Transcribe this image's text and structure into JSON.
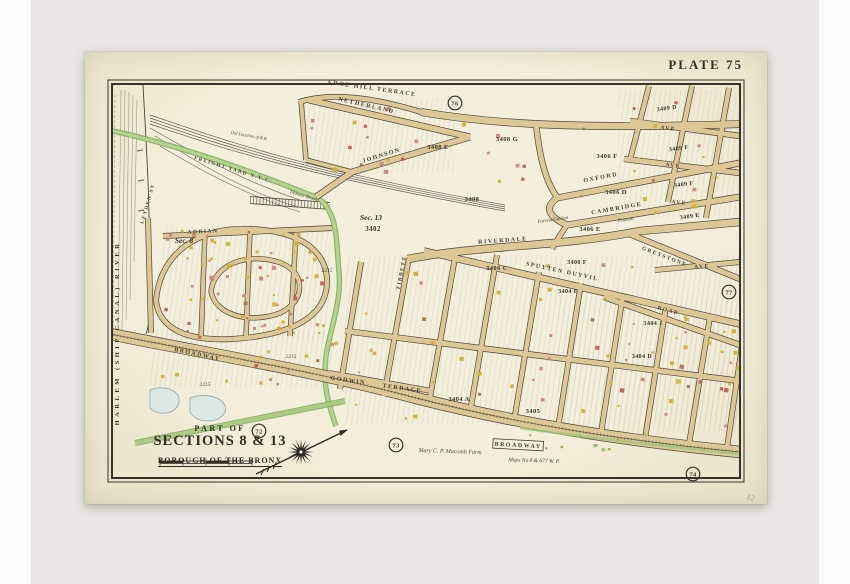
{
  "header": {
    "plate_label": "PLATE 75"
  },
  "title_block": {
    "part_of": "PART OF",
    "sections": "SECTIONS 8 & 13",
    "borough": "BOROUGH OF THE BRONX"
  },
  "map": {
    "colors": {
      "backdrop": "#e9e7e3",
      "paper": "#f2edd9",
      "road": "#dcc795",
      "ink": "#3f3b30",
      "brook": "#a6cb82",
      "building_yellow": "#d2b02c",
      "building_pink": "#cd8478",
      "building_red": "#bf5c4b",
      "building_brown": "#a8744d"
    },
    "labels": [
      {
        "t": "EDGE HILL TERRACE",
        "x": 372,
        "y": 90,
        "r": 8,
        "s": 6,
        "c": "st"
      },
      {
        "t": "NETHERLAND",
        "x": 366,
        "y": 107,
        "r": 13,
        "s": 6,
        "c": "st"
      },
      {
        "t": "JOHNSON",
        "x": 382,
        "y": 157,
        "r": -17,
        "s": 6,
        "c": "st"
      },
      {
        "t": "OXFORD",
        "x": 601,
        "y": 179,
        "r": -11,
        "s": 6,
        "c": "st"
      },
      {
        "t": "CAMBRIDGE",
        "x": 617,
        "y": 210,
        "r": -10,
        "s": 6,
        "c": "st"
      },
      {
        "t": "AVE",
        "x": 668,
        "y": 130,
        "r": 7,
        "s": 5.5,
        "c": "st"
      },
      {
        "t": "AVE",
        "x": 673,
        "y": 167,
        "r": 7,
        "s": 5.5,
        "c": "st"
      },
      {
        "t": "AVE",
        "x": 679,
        "y": 204,
        "r": 6,
        "s": 5.5,
        "c": "st"
      },
      {
        "t": "RIVERDALE",
        "x": 503,
        "y": 242,
        "r": -4,
        "s": 6,
        "c": "st"
      },
      {
        "t": "SPUYTEN DUYVIL",
        "x": 562,
        "y": 273,
        "r": 12,
        "s": 6,
        "c": "st"
      },
      {
        "t": "GREYSTONE",
        "x": 664,
        "y": 258,
        "r": 21,
        "s": 5.5,
        "c": "st"
      },
      {
        "t": "ROAD",
        "x": 668,
        "y": 312,
        "r": 15,
        "s": 5.5,
        "c": "st"
      },
      {
        "t": "AVE",
        "x": 702,
        "y": 268,
        "r": -3,
        "s": 5.5,
        "c": "st"
      },
      {
        "t": "TIBBETT",
        "x": 403,
        "y": 273,
        "r": -79,
        "s": 5.5,
        "c": "st"
      },
      {
        "t": "GODWIN",
        "x": 348,
        "y": 382,
        "r": 8,
        "s": 6,
        "c": "st"
      },
      {
        "t": "TERRACE",
        "x": 402,
        "y": 390,
        "r": 8,
        "s": 6,
        "c": "st"
      },
      {
        "t": "BROADWAY",
        "x": 197,
        "y": 356,
        "r": 12,
        "s": 6,
        "c": "st"
      },
      {
        "t": "ADRIAN",
        "x": 203,
        "y": 233,
        "r": -3,
        "s": 5.5,
        "c": "st"
      },
      {
        "t": "FREIGHT YARD N.Y.C.",
        "x": 233,
        "y": 171,
        "r": 17,
        "s": 5,
        "c": "st"
      },
      {
        "t": "LEYDEN ST",
        "x": 149,
        "y": 204,
        "r": -74,
        "s": 5,
        "c": "st"
      },
      {
        "t": "HARLEM (SHIP CANAL) RIVER",
        "x": 119,
        "y": 333,
        "r": -90,
        "s": 6.5,
        "c": "riv"
      },
      {
        "t": "BROADWAY",
        "x": 518,
        "y": 447,
        "r": 3,
        "s": 6,
        "c": "box"
      },
      {
        "t": "Sec. 8",
        "x": 184,
        "y": 243,
        "r": 0,
        "s": 7.5,
        "c": "sec"
      },
      {
        "t": "Sec. 13",
        "x": 371,
        "y": 220,
        "r": 0,
        "s": 7.5,
        "c": "sec"
      },
      {
        "t": "3402",
        "x": 373,
        "y": 231,
        "r": 0,
        "s": 7,
        "c": "num"
      },
      {
        "t": "3408 G",
        "x": 507,
        "y": 141,
        "r": 0,
        "s": 6.5,
        "c": "num"
      },
      {
        "t": "3408 E",
        "x": 438,
        "y": 149,
        "r": 0,
        "s": 6.5,
        "c": "num"
      },
      {
        "t": "3408",
        "x": 472,
        "y": 201,
        "r": 0,
        "s": 6.5,
        "c": "num"
      },
      {
        "t": "3409 D",
        "x": 667,
        "y": 110,
        "r": -8,
        "s": 6,
        "c": "num"
      },
      {
        "t": "3409 F",
        "x": 679,
        "y": 150,
        "r": -8,
        "s": 6,
        "c": "num"
      },
      {
        "t": "3409 F",
        "x": 684,
        "y": 186,
        "r": -8,
        "s": 6,
        "c": "num"
      },
      {
        "t": "3409 E",
        "x": 690,
        "y": 218,
        "r": -8,
        "s": 6,
        "c": "num"
      },
      {
        "t": "3406 F",
        "x": 607,
        "y": 158,
        "r": 0,
        "s": 6.5,
        "c": "num"
      },
      {
        "t": "3406 D",
        "x": 616,
        "y": 194,
        "r": 0,
        "s": 6.5,
        "c": "num"
      },
      {
        "t": "3406 E",
        "x": 590,
        "y": 231,
        "r": 0,
        "s": 6.5,
        "c": "num"
      },
      {
        "t": "3406 C",
        "x": 497,
        "y": 270,
        "r": 0,
        "s": 6.5,
        "c": "num"
      },
      {
        "t": "3400 F",
        "x": 577,
        "y": 264,
        "r": 0,
        "s": 6,
        "c": "num"
      },
      {
        "t": "3404 F",
        "x": 568,
        "y": 293,
        "r": 0,
        "s": 6,
        "c": "num"
      },
      {
        "t": "3404 J",
        "x": 653,
        "y": 325,
        "r": 0,
        "s": 6,
        "c": "num"
      },
      {
        "t": "3404 D",
        "x": 642,
        "y": 358,
        "r": 0,
        "s": 6,
        "c": "num"
      },
      {
        "t": "3404 A",
        "x": 459,
        "y": 401,
        "r": 0,
        "s": 6.5,
        "c": "num"
      },
      {
        "t": "3405",
        "x": 533,
        "y": 413,
        "r": 0,
        "s": 6.5,
        "c": "num"
      },
      {
        "t": "2215",
        "x": 327,
        "y": 272,
        "r": 0,
        "s": 5.5,
        "c": "it"
      },
      {
        "t": "2215",
        "x": 205,
        "y": 386,
        "r": 0,
        "s": 5.5,
        "c": "it"
      },
      {
        "t": "2215",
        "x": 291,
        "y": 358,
        "r": 0,
        "s": 5.5,
        "c": "it"
      },
      {
        "t": "Mary C. P. Macomb Farm",
        "x": 450,
        "y": 453,
        "r": 2,
        "s": 6,
        "c": "it"
      },
      {
        "t": "Maps No 8 & 677 W. P.",
        "x": 534,
        "y": 462,
        "r": 2,
        "s": 5.5,
        "c": "it"
      },
      {
        "t": "Forrest Garden",
        "x": 553,
        "y": 221,
        "r": -8,
        "s": 5,
        "c": "it"
      },
      {
        "t": "Putnam",
        "x": 626,
        "y": 221,
        "r": -8,
        "s": 5,
        "c": "it"
      },
      {
        "t": "Tibbetts Brook",
        "x": 303,
        "y": 197,
        "r": 17,
        "s": 5,
        "c": "it"
      },
      {
        "t": "Old Location of R.R.",
        "x": 249,
        "y": 137,
        "r": 10,
        "s": 4.5,
        "c": "it"
      },
      {
        "t": "12",
        "x": 750,
        "y": 500,
        "r": 14,
        "s": 8,
        "c": "pencil"
      }
    ],
    "circles": [
      {
        "n": "76",
        "x": 455,
        "y": 103
      },
      {
        "n": "77",
        "x": 729,
        "y": 292
      },
      {
        "n": "72",
        "x": 259,
        "y": 431
      },
      {
        "n": "73",
        "x": 396,
        "y": 445
      },
      {
        "n": "74",
        "x": 693,
        "y": 474
      }
    ]
  }
}
